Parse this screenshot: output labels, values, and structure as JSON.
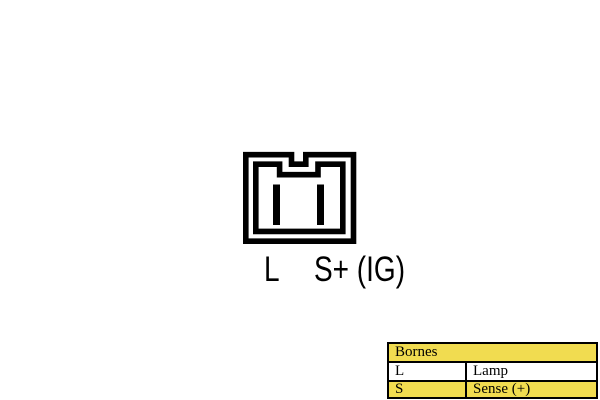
{
  "page": {
    "background_color": "#ffffff",
    "line_color": "#000000"
  },
  "diagram": {
    "type": "connector-pinout",
    "pin_count": 2,
    "pin_labels": {
      "left": "L",
      "right": "S+ (IG)"
    }
  },
  "table": {
    "title": "Bornes",
    "rows": [
      {
        "terminal": "L",
        "description": "Lamp"
      },
      {
        "terminal": "S",
        "description": "Sense (+)"
      }
    ],
    "colors": {
      "header_bg": "#F1DC50",
      "row_lamp_bg": "#FFFFFF",
      "row_sense_bg": "#F1DC50",
      "border": "#000000",
      "text": "#000000"
    }
  }
}
